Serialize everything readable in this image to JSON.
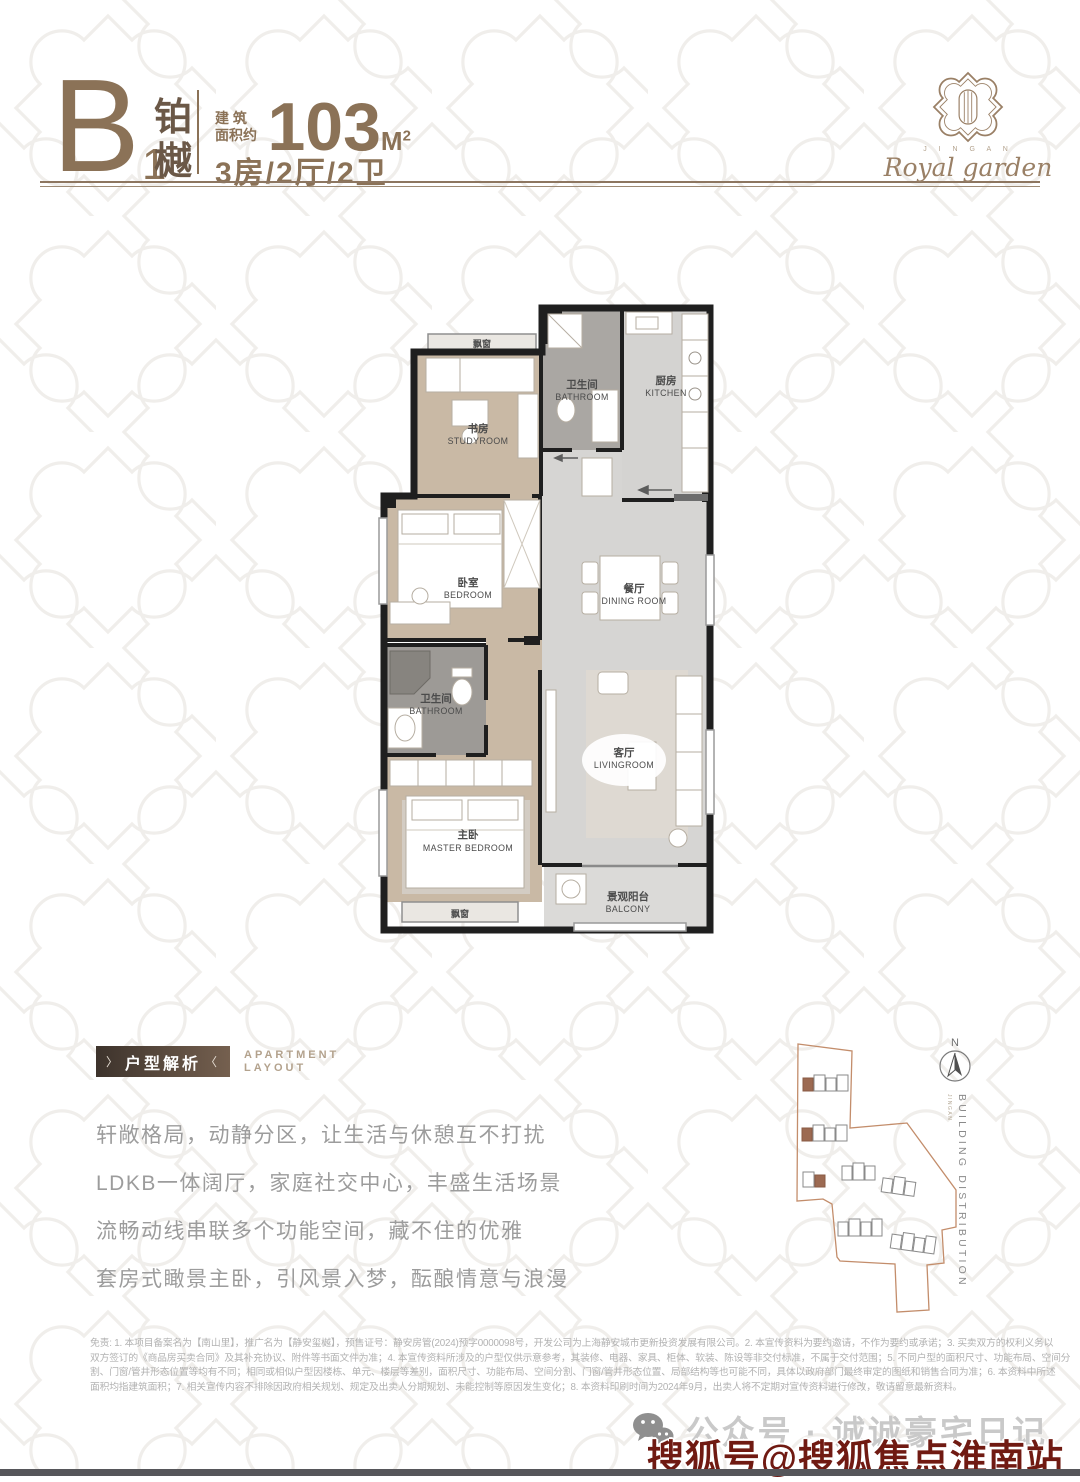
{
  "header": {
    "unit_code": "B",
    "unit_sub": "1",
    "unit_name_chars": [
      "铂",
      "樾"
    ],
    "area_label_top": "建 筑",
    "area_label_bottom": "面积约",
    "area_value": "103",
    "area_unit": "M",
    "area_unit_sup": "2",
    "spec": "3房/2厅/2卫"
  },
  "logo": {
    "small_caps": "J I N G A N",
    "script": "Royal garden"
  },
  "plan": {
    "bay_top": "飘窗",
    "bay_bottom": "飘窗",
    "rooms": [
      {
        "zh": "书房",
        "en": "STUDYROOM"
      },
      {
        "zh": "卫生间",
        "en": "BATHROOM"
      },
      {
        "zh": "厨房",
        "en": "KITCHEN"
      },
      {
        "zh": "卧室",
        "en": "BEDROOM"
      },
      {
        "zh": "餐厅",
        "en": "DINING ROOM"
      },
      {
        "zh": "卫生间",
        "en": "BATHROOM"
      },
      {
        "zh": "主卧",
        "en": "MASTER BEDROOM"
      },
      {
        "zh": "客厅",
        "en": "LIVINGROOM"
      },
      {
        "zh": "景观阳台",
        "en": "BALCONY"
      }
    ]
  },
  "analysis": {
    "deco_left": "〉",
    "title": "户型解析",
    "deco_right": "〈",
    "subtitle_line1": "APARTMENT",
    "subtitle_line2": "LAYOUT",
    "lines": [
      "轩敞格局，动静分区，让生活与休憩互不打扰",
      "LDKB一体阔厅，家庭社交中心，丰盛生活场景",
      "流畅动线串联多个功能空间，藏不住的优雅",
      "套房式瞰景主卧，引风景入梦，酝酿情意与浪漫"
    ]
  },
  "siteplan": {
    "compass": "N",
    "label": "BUILDING DISTRIBUTION",
    "label_small": "JINGAN"
  },
  "disclaimer": {
    "lines": [
      "免责: 1. 本项目备案名为【南山里】，推广名为【静安玺樾】，预售证号：静安房管(2024)预字0000098号，开发公司为上海静安城市更新投资发展有限公司。2. 本宣传资料为要约邀请，不作为要约或承诺；3. 买卖双方的权利义务以",
      "双方签订的《商品房买卖合同》及其补充协议、附件等书面文件为准；4. 本宣传资料所涉及的户型仅供示意参考，其装修、电器、家具、柜体、软装、陈设等非交付标准，不属于交付范围；5. 不同户型的面积尺寸、功能布局、空间分",
      "割、门窗/管井形态位置等均有不同；相同或相似户型因楼栋、单元、楼层等差别，面积尺寸、功能布局、空间分割、门窗/管井形态位置、局部结构等也可能不同，具体以政府部门最终审定的图纸和销售合同为准；6. 本资料中所述",
      "面积均指建筑面积；7. 相关宣传内容不排除因政府相关规划、规定及出卖人分期规划、未能控制等原因发生变化；8. 本资料印刷时间为2024年9月，出卖人将不定期对宣传资料进行修改，敬请留意最新资料。"
    ]
  },
  "footer": {
    "wechat_label": "公众号 · 诚诚豪宅日记",
    "watermark": "搜狐号@搜狐焦点淮南站"
  },
  "colors": {
    "accent_brown": "#8b7257",
    "dark_brown": "#6b5847",
    "wood_floor": "#c9b9a5",
    "marble": "#d6d5d3",
    "wall": "#1f1f1f",
    "site_outline": "#c38d6b",
    "building_highlight": "#9c6a52",
    "watermark_red": "#701a12"
  }
}
